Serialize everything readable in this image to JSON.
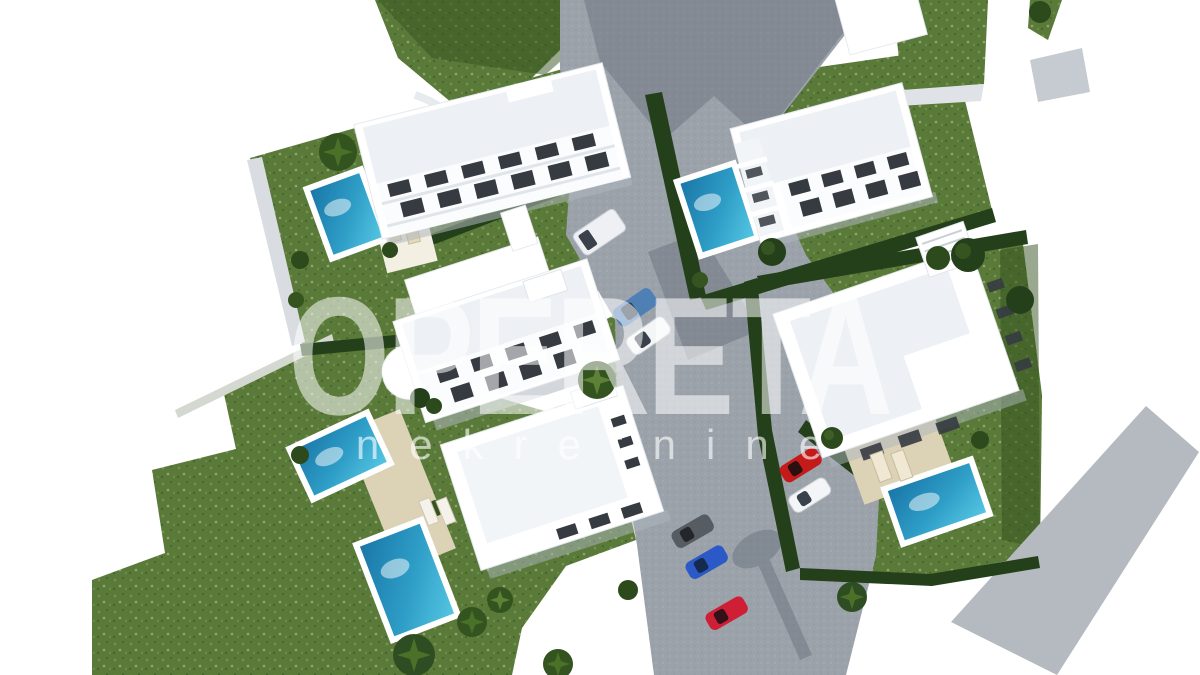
{
  "image": {
    "description": "3D aerial architectural rendering of a residential development: white apartment buildings and villas with private pools, green gardens, hedges, palm trees, gray access roads and parked cars, on a white background",
    "width_px": 1200,
    "height_px": 675,
    "background": "#ffffff"
  },
  "watermark": {
    "title": "OPERETA",
    "subtitle": "nekretnine"
  },
  "palette": {
    "lawn": "#5a7a39",
    "lawn_shade": "#33511f",
    "hedge": "#24401a",
    "road": "#9ba2aa",
    "road_light": "#b5bac0",
    "road_shadow": "#5c646e",
    "building_white": "#ffffff",
    "roof_tint": "#edf1f5",
    "window_dark": "#363b42",
    "pool_deep": "#1a77a8",
    "pool_light": "#55c5e3",
    "deck_wood": "#dcd2b6",
    "wall_light": "#d9dde2",
    "car_red": "#c41a1a",
    "car_blue": "#2b59c8",
    "car_steel_blue": "#4e7fb5",
    "car_white": "#f3f5f7",
    "car_gray": "#575c62"
  },
  "scene": {
    "buildings": [
      "apartment-building-top-left",
      "apartment-building-top-right",
      "apartment-building-center-left",
      "villa-bottom-center",
      "villa-right",
      "building-fragment-top-corner"
    ],
    "pools_count": 5,
    "cars": [
      {
        "type": "van",
        "color": "white"
      },
      {
        "type": "sedan",
        "color": "steel-blue"
      },
      {
        "type": "sedan",
        "color": "white"
      },
      {
        "type": "sedan",
        "color": "red"
      },
      {
        "type": "sedan",
        "color": "white"
      },
      {
        "type": "sedan",
        "color": "gray"
      },
      {
        "type": "sedan",
        "color": "blue"
      },
      {
        "type": "sedan",
        "color": "red"
      }
    ],
    "landscape": [
      "lawns",
      "hedges",
      "palm-trees",
      "sun-loungers",
      "wooden-decks",
      "access-roads",
      "parking-area"
    ]
  }
}
